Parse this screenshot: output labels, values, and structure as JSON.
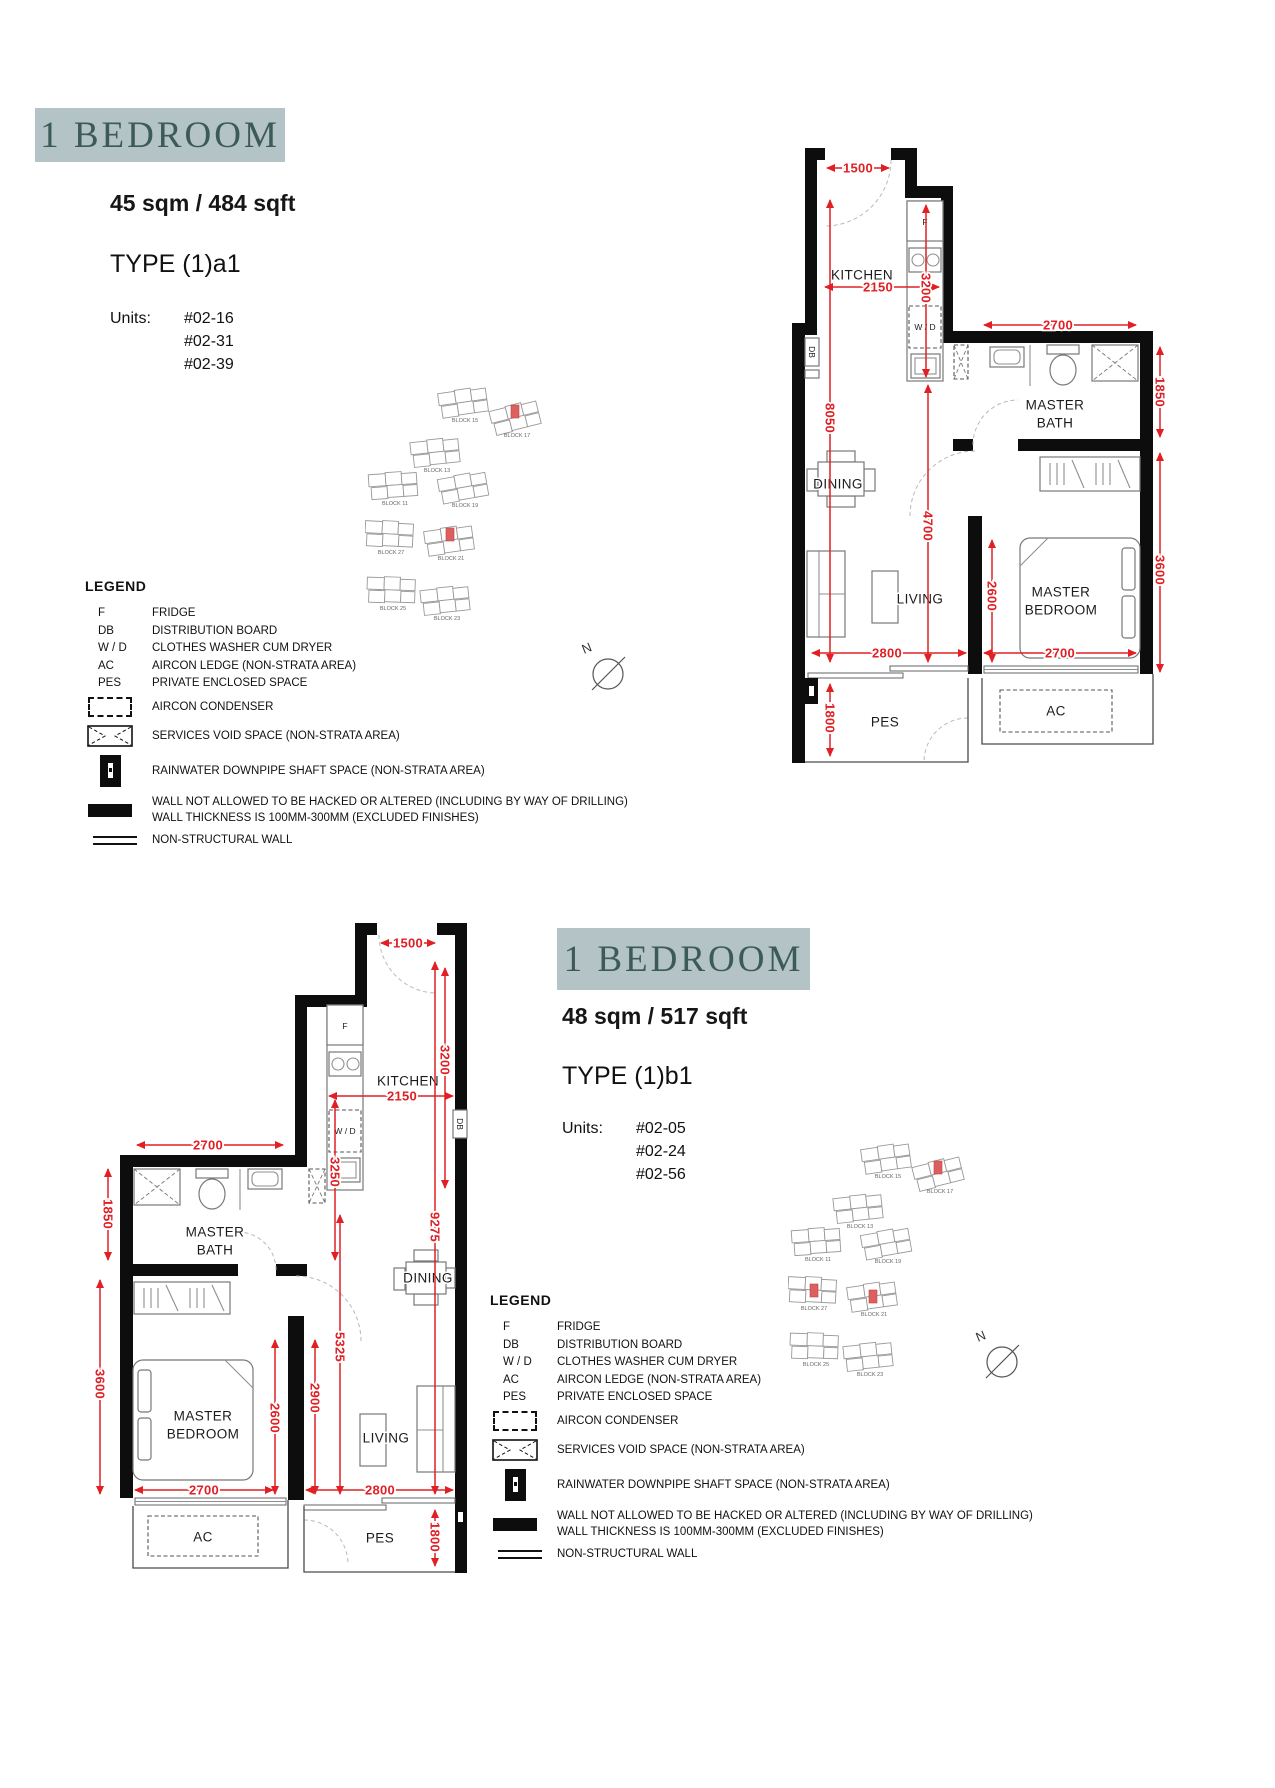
{
  "colors": {
    "badge_bg": "#b4c3c5",
    "badge_text": "#3c5a58",
    "dimension_red": "#e02025",
    "wall_black": "#0d0d0d",
    "site_highlight": "#dd5f60"
  },
  "north_label": "N",
  "legend": {
    "title": "LEGEND",
    "abbrev_rows": [
      {
        "key": "F",
        "desc": "FRIDGE"
      },
      {
        "key": "DB",
        "desc": "DISTRIBUTION BOARD"
      },
      {
        "key": "W / D",
        "desc": "CLOTHES WASHER CUM DRYER"
      },
      {
        "key": "AC",
        "desc": "AIRCON LEDGE (NON-STRATA AREA)"
      },
      {
        "key": "PES",
        "desc": "PRIVATE ENCLOSED SPACE"
      }
    ],
    "symbol_rows": [
      {
        "icon": "aircon-condenser",
        "desc": "AIRCON CONDENSER"
      },
      {
        "icon": "services-void",
        "desc": "SERVICES VOID SPACE (NON-STRATA AREA)"
      },
      {
        "icon": "rainwater-downpipe",
        "desc": "RAINWATER DOWNPIPE SHAFT SPACE (NON-STRATA AREA)"
      },
      {
        "icon": "no-hack-wall",
        "desc": "WALL NOT ALLOWED TO BE HACKED OR ALTERED (INCLUDING BY WAY OF DRILLING)",
        "desc2": "WALL THICKNESS IS 100MM-300MM (EXCLUDED FINISHES)"
      },
      {
        "icon": "non-structural-wall",
        "desc": "NON-STRUCTURAL WALL"
      }
    ]
  },
  "site_blocks": [
    "BLOCK 15",
    "BLOCK 17",
    "BLOCK 13",
    "BLOCK 11",
    "BLOCK 19",
    "BLOCK 27",
    "BLOCK 21",
    "BLOCK 25",
    "BLOCK 23"
  ],
  "sections": [
    {
      "badge": "1 BEDROOM",
      "area": "45 sqm / 484 sqft",
      "unit_type": "TYPE (1)a1",
      "units_label": "Units:",
      "units": [
        "#02-16",
        "#02-31",
        "#02-39"
      ],
      "rooms": {
        "kitchen": "KITCHEN",
        "dining": "DINING",
        "living": "LIVING",
        "bath1": "MASTER",
        "bath2": "BATH",
        "bed1": "MASTER",
        "bed2": "BEDROOM",
        "ac": "AC",
        "pes": "PES"
      },
      "tags": {
        "f": "F",
        "wd": "W / D",
        "db": "DB"
      },
      "dims": {
        "entry_width": "1500",
        "kitchen_width": "2150",
        "kitchen_depth": "3200",
        "total_depth": "8050",
        "bath_width": "2700",
        "bath_depth": "1850",
        "bedroom_depth": "3600",
        "living_span": "4700",
        "bedroom_clear": "2600",
        "living_width": "2800",
        "bedroom_width": "2700",
        "pes_depth": "1800"
      }
    },
    {
      "badge": "1 BEDROOM",
      "area": "48 sqm / 517 sqft",
      "unit_type": "TYPE (1)b1",
      "units_label": "Units:",
      "units": [
        "#02-05",
        "#02-24",
        "#02-56"
      ],
      "rooms": {
        "kitchen": "KITCHEN",
        "dining": "DINING",
        "living": "LIVING",
        "bath1": "MASTER",
        "bath2": "BATH",
        "bed1": "MASTER",
        "bed2": "BEDROOM",
        "ac": "AC",
        "pes": "PES"
      },
      "tags": {
        "f": "F",
        "wd": "W / D",
        "db": "DB"
      },
      "dims": {
        "entry_width": "1500",
        "kitchen_width": "2150",
        "kitchen_depth": "3200",
        "counter_depth": "3250",
        "total_depth": "9275",
        "bath_width": "2700",
        "bath_depth": "1850",
        "bedroom_depth": "3600",
        "hall_span": "5325",
        "bedroom_clear": "2600",
        "living_clear": "2900",
        "bedroom_width": "2700",
        "living_width": "2800",
        "pes_depth": "1800"
      }
    }
  ]
}
